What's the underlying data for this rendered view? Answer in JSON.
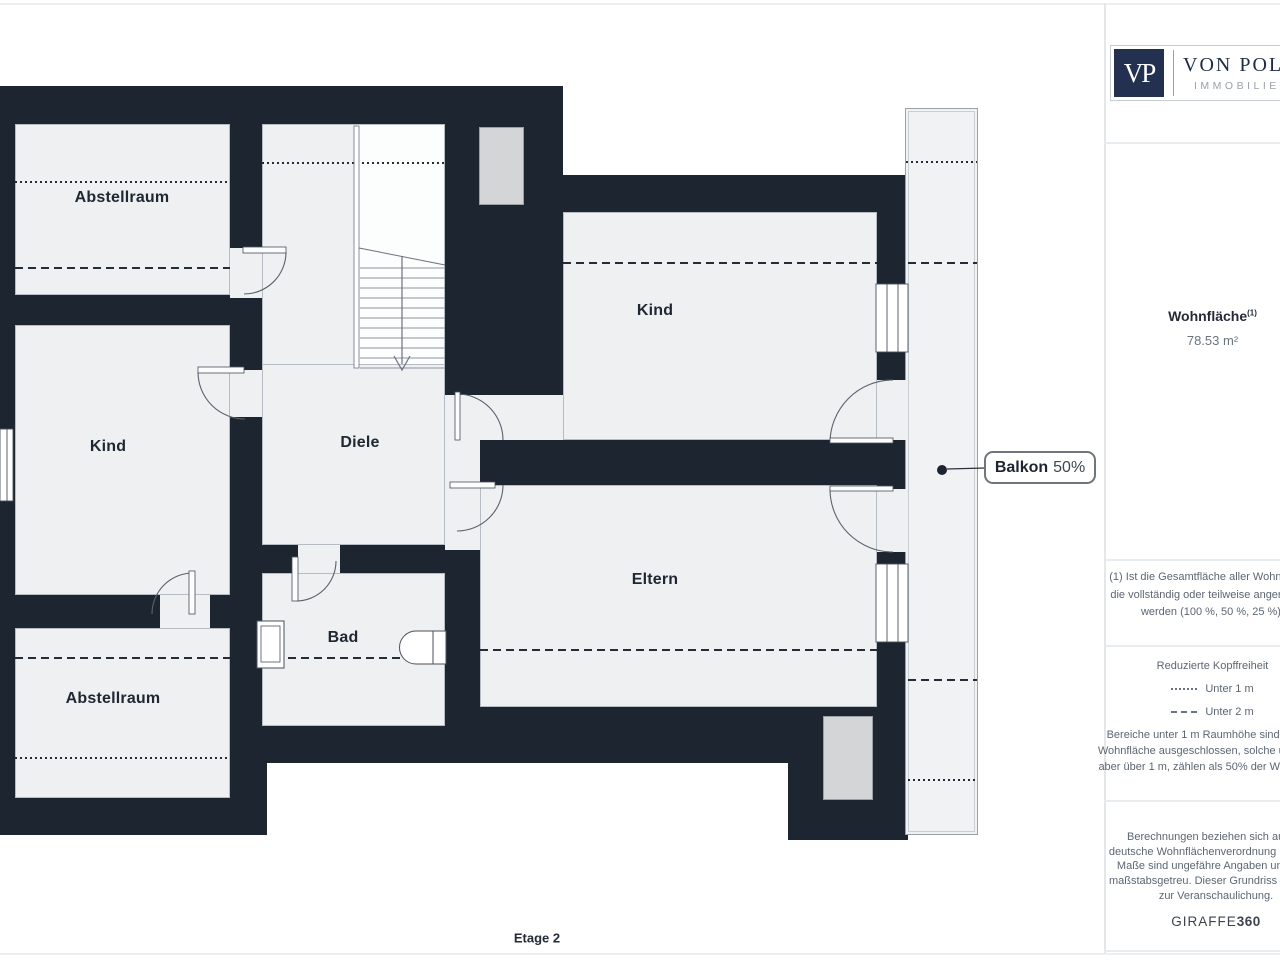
{
  "page": {
    "floor_label": "Etage 2"
  },
  "rooms": {
    "abstellraum_top": "Abstellraum",
    "kind_left": "Kind",
    "abstellraum_bottom": "Abstellraum",
    "diele": "Diele",
    "bad": "Bad",
    "kind_right": "Kind",
    "eltern": "Eltern"
  },
  "callout": {
    "bold": "Balkon",
    "rest": "50%"
  },
  "colors": {
    "wall": "#1d2531",
    "room_fill": "#eef0f1",
    "shaft_fill": "#d4d5d7",
    "brand_navy": "#233050"
  },
  "sidebar": {
    "logo": {
      "monogram": "VP",
      "name": "VON POLL",
      "subtitle": "IMMOBILIEN"
    },
    "area": {
      "label": "Wohnfläche",
      "superscript": "(1)",
      "value": "78.53 m²"
    },
    "footnote": "(1) Ist die Gesamtfläche aller Wohnräume, die vollständig oder teilweise angerechnet werden (100 %, 50 %, 25 %).",
    "legend": {
      "title": "Reduzierte Kopffreiheit",
      "items": [
        {
          "style": "dotted",
          "label": "Unter 1 m"
        },
        {
          "style": "dashed",
          "label": "Unter 2 m"
        }
      ],
      "note": "Bereiche unter 1 m Raumhöhe sind von der Wohnfläche ausgeschlossen, solche unter 2 m, aber über 1 m, zählen als 50% der Wohnfläche"
    },
    "disclaimer": "Berechnungen beziehen sich auf die deutsche Wohnflächenverordnung (WoFIV). Maße sind ungefähre Angaben und nicht maßstabsgetreu. Dieser Grundriss dient nur zur Veranschaulichung.",
    "brand": {
      "name": "GIRAFFE",
      "suffix": "360"
    }
  }
}
